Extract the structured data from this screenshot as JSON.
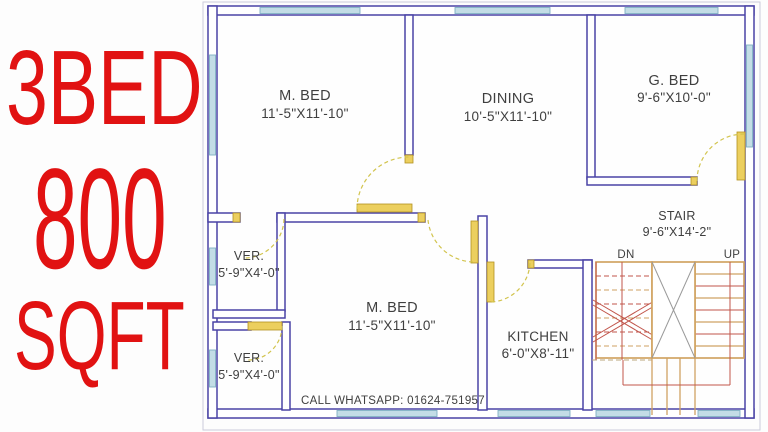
{
  "badge": {
    "line1": "3BED",
    "line2": "800",
    "line3": "SQFT",
    "color": "#e11212"
  },
  "plan": {
    "rooms": {
      "m_bed_top": {
        "name": "M. BED",
        "dims": "11'-5\"X11'-10\""
      },
      "dining": {
        "name": "DINING",
        "dims": "10'-5\"X11'-10\""
      },
      "g_bed": {
        "name": "G. BED",
        "dims": "9'-6\"X10'-0\""
      },
      "stair": {
        "name": "STAIR",
        "dims": "9'-6\"X14'-2\""
      },
      "ver_1": {
        "name": "VER.",
        "dims": "5'-9\"X4'-0\""
      },
      "m_bed_bottom": {
        "name": "M. BED",
        "dims": "11'-5\"X11'-10\""
      },
      "ver_2": {
        "name": "VER.",
        "dims": "5'-9\"X4'-0\""
      },
      "kitchen": {
        "name": "KITCHEN",
        "dims": "6'-0\"X8'-11\""
      }
    },
    "stair_labels": {
      "down": "DN",
      "up": "UP"
    },
    "contact": "CALL WHATSAPP: 01624-751957",
    "colors": {
      "wall": "#4a43a6",
      "window_fill": "#c3dde6",
      "door": "#eccf5e",
      "door_arc": "#d2c44e",
      "stair_tan": "#cfa263",
      "stair_red": "#c1554b",
      "label_text": "#3f3f3f"
    }
  }
}
